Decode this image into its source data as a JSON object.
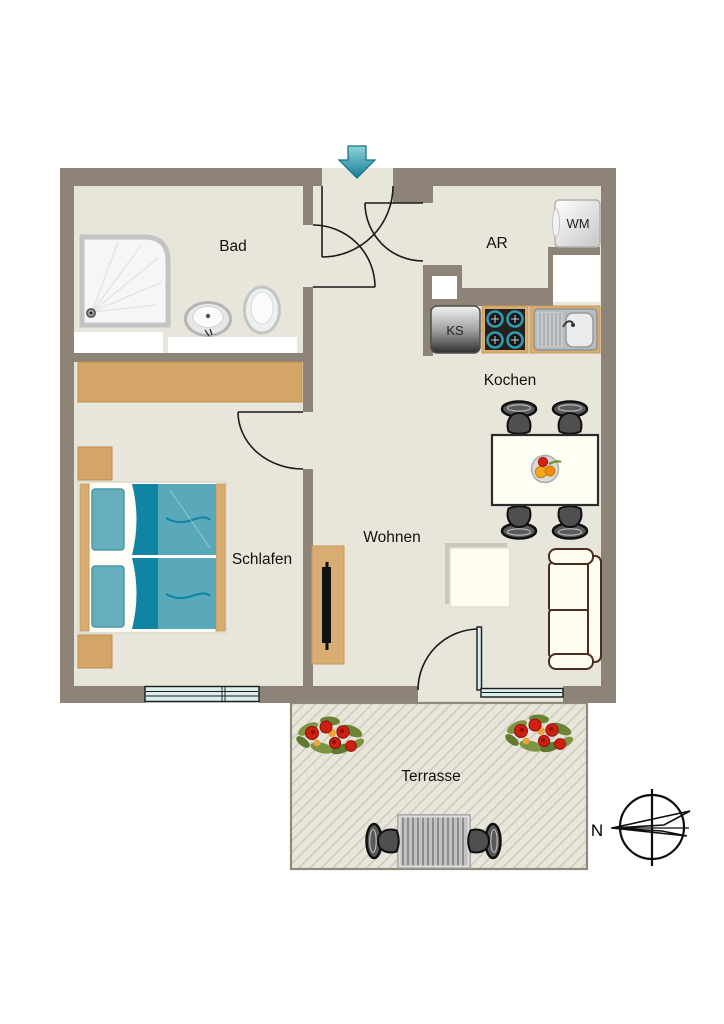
{
  "diagram": {
    "type": "apartment-floor-plan",
    "rooms": [
      {
        "id": "bad",
        "label": "Bad"
      },
      {
        "id": "ar",
        "label": "AR"
      },
      {
        "id": "kochen",
        "label": "Kochen"
      },
      {
        "id": "schlafen",
        "label": "Schlafen"
      },
      {
        "id": "wohnen",
        "label": "Wohnen"
      },
      {
        "id": "terrasse",
        "label": "Terrasse"
      }
    ],
    "appliances": [
      {
        "id": "washing-machine",
        "label": "WM"
      },
      {
        "id": "fridge",
        "label": "KS"
      }
    ],
    "compass": {
      "north_label": "N"
    },
    "colors": {
      "wall": "#8d8477",
      "floor": "#e8e5da",
      "terrace_hatch": "#ccc8ba",
      "terrace_border": "#8f8a7a",
      "wood": "#d3a567",
      "counter_wood": "#d9ad72",
      "bed_blanket": "#5aa9ba",
      "bed_fold": "#0f85a3",
      "bed_pillow": "#66aebb",
      "entry_arrow": "#2a96ad",
      "flower_red": "#cf1f10",
      "leaf_green": "#7f9440",
      "glazing": "#d9edee",
      "sofa_outline": "#4a2d1f",
      "chair_dark": "#4f4f4f"
    }
  }
}
